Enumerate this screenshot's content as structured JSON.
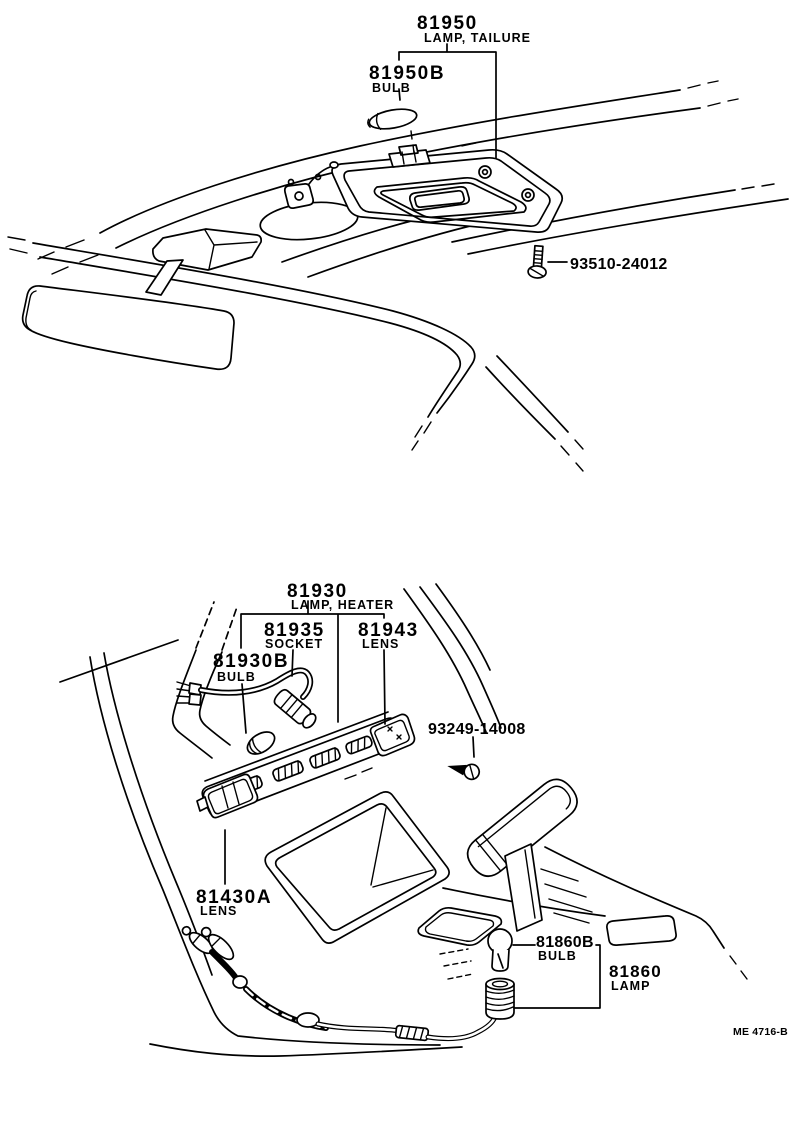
{
  "colors": {
    "ink": "#000000",
    "paper": "#ffffff"
  },
  "labels": {
    "tailure_lamp": {
      "part": "81950",
      "name": "LAMP, TAILURE"
    },
    "tailure_bulb": {
      "part": "81950B",
      "name": "BULB"
    },
    "roof_screw": {
      "part": "93510-24012"
    },
    "heater_lamp": {
      "part": "81930",
      "name": "LAMP, HEATER"
    },
    "heater_socket": {
      "part": "81935",
      "name": "SOCKET"
    },
    "heater_lens": {
      "part": "81943",
      "name": "LENS"
    },
    "heater_bulb": {
      "part": "81930B",
      "name": "BULB"
    },
    "console_screw": {
      "part": "93249-14008"
    },
    "console_lens": {
      "part": "81430A",
      "name": "LENS"
    },
    "console_bulb": {
      "part": "81860B",
      "name": "BULB"
    },
    "console_lamp": {
      "part": "81860",
      "name": "LAMP"
    }
  },
  "footer": {
    "drawing_code": "ME 4716-B"
  }
}
